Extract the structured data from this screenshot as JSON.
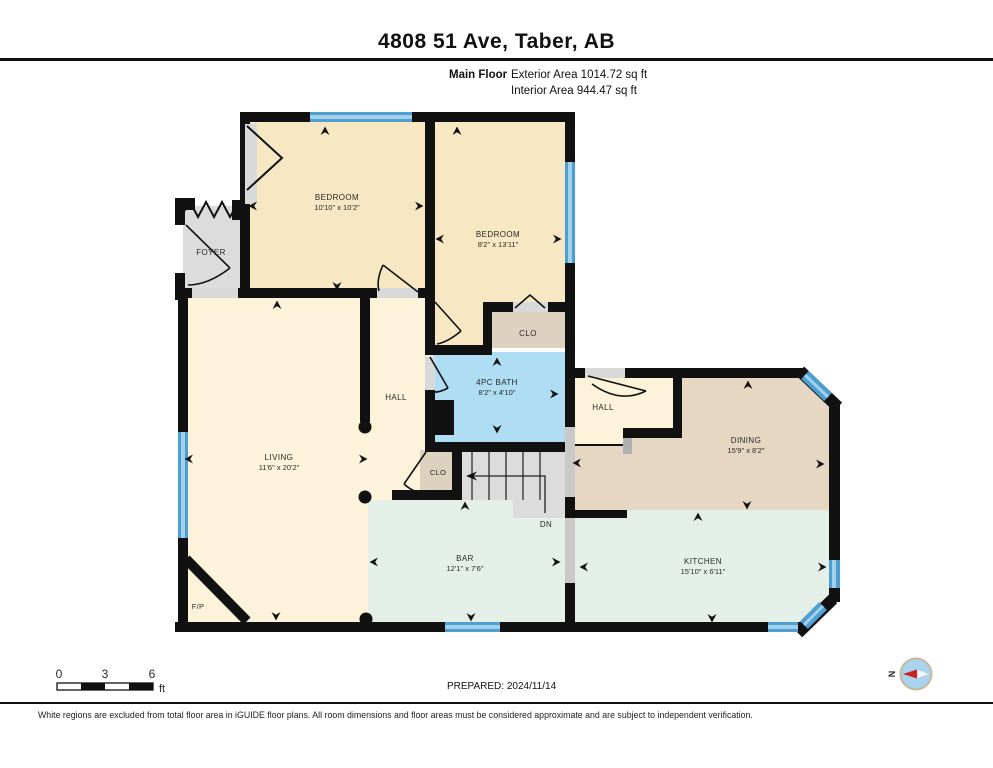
{
  "header": {
    "title": "4808 51 Ave, Taber, AB",
    "floor_label": "Main Floor",
    "exterior_area": "Exterior Area 1014.72 sq ft",
    "interior_area": "Interior Area 944.47 sq ft"
  },
  "rooms": {
    "bedroom1": {
      "name": "BEDROOM",
      "dims": "10'10\" x 10'2\""
    },
    "bedroom2": {
      "name": "BEDROOM",
      "dims": "8'2\" x 13'11\""
    },
    "foyer": {
      "name": "FOYER"
    },
    "hall_center": {
      "name": "HALL"
    },
    "bath": {
      "name": "4PC BATH",
      "dims": "8'2\" x 4'10\""
    },
    "closet_upper": {
      "name": "CLO"
    },
    "hall_right": {
      "name": "HALL"
    },
    "dining": {
      "name": "DINING",
      "dims": "15'9\" x 8'2\""
    },
    "living": {
      "name": "LIVING",
      "dims": "11'6\" x 20'2\""
    },
    "closet_stairs": {
      "name": "CLO"
    },
    "stairs": {
      "name": "DN"
    },
    "bar": {
      "name": "BAR",
      "dims": "12'1\" x 7'6\""
    },
    "kitchen": {
      "name": "KITCHEN",
      "dims": "15'10\" x 6'11\""
    },
    "fireplace": {
      "name": "F/P"
    }
  },
  "scale_bar": {
    "tick0": "0",
    "tick1": "3",
    "tick2": "6",
    "unit": "ft"
  },
  "footer": {
    "prepared": "PREPARED: 2024/11/14",
    "compass_label": "N",
    "disclaimer": "White regions are excluded from total floor area in iGUIDE floor plans. All room dimensions and floor areas must be considered approximate and are subject to independent verification."
  },
  "colors": {
    "wall": "#111111",
    "bedroom": "#f8e7c3",
    "living": "#fcf3da",
    "bath": "#aeddf4",
    "closet": "#ddd1bf",
    "dining": "#e5d7c2",
    "kitchen": "#e4efe8",
    "gray_floor": "#dcdcdc",
    "window": "#4d9fd2",
    "window_light": "#a5d0ea",
    "compass_fill": "#a9d3ee",
    "compass_needle": "#cc2222"
  }
}
